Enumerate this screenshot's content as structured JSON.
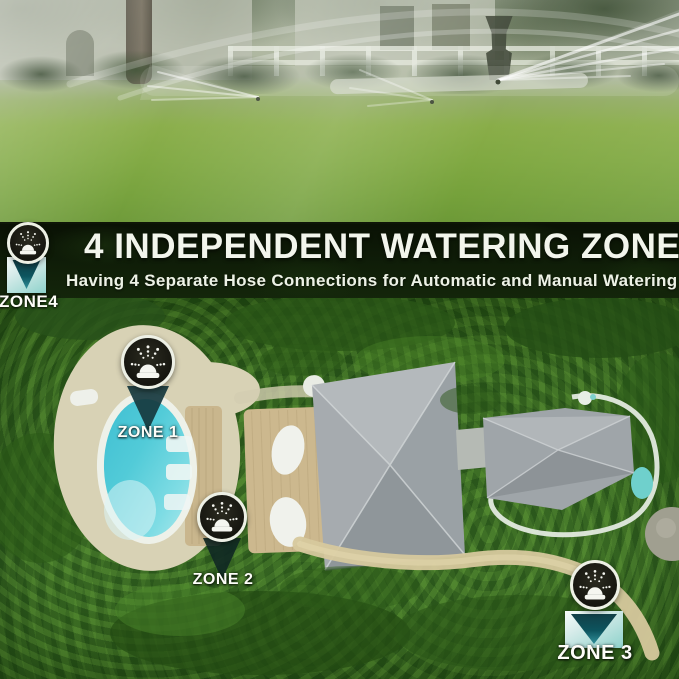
{
  "banner": {
    "title": "4 INDEPENDENT WATERING ZONE",
    "subtitle": "Having 4 Separate Hose Connections for Automatic and Manual Watering"
  },
  "zones": [
    {
      "id": "zone-1",
      "label": "ZONE 1"
    },
    {
      "id": "zone-2",
      "label": "ZONE 2"
    },
    {
      "id": "zone-3",
      "label": "ZONE 3"
    },
    {
      "id": "zone-4",
      "label": "ZONE4"
    }
  ],
  "icons": {
    "zone_badge": "sprinkler-icon",
    "zone_pointer": "pin-pointer-icon"
  },
  "colors": {
    "pool_water": "#4fc8d6",
    "pointer_teal": "#0d545e",
    "badge_dark": "#15150f",
    "banner_background": "#0b1405",
    "banner_text": "#f2f5ec",
    "lawn_green": "#7ca63c",
    "foliage_green": "#33621c",
    "sand": "#d8d2b5",
    "roof_gray": "#a3a9ac",
    "deck_wood": "#ccb88e"
  }
}
